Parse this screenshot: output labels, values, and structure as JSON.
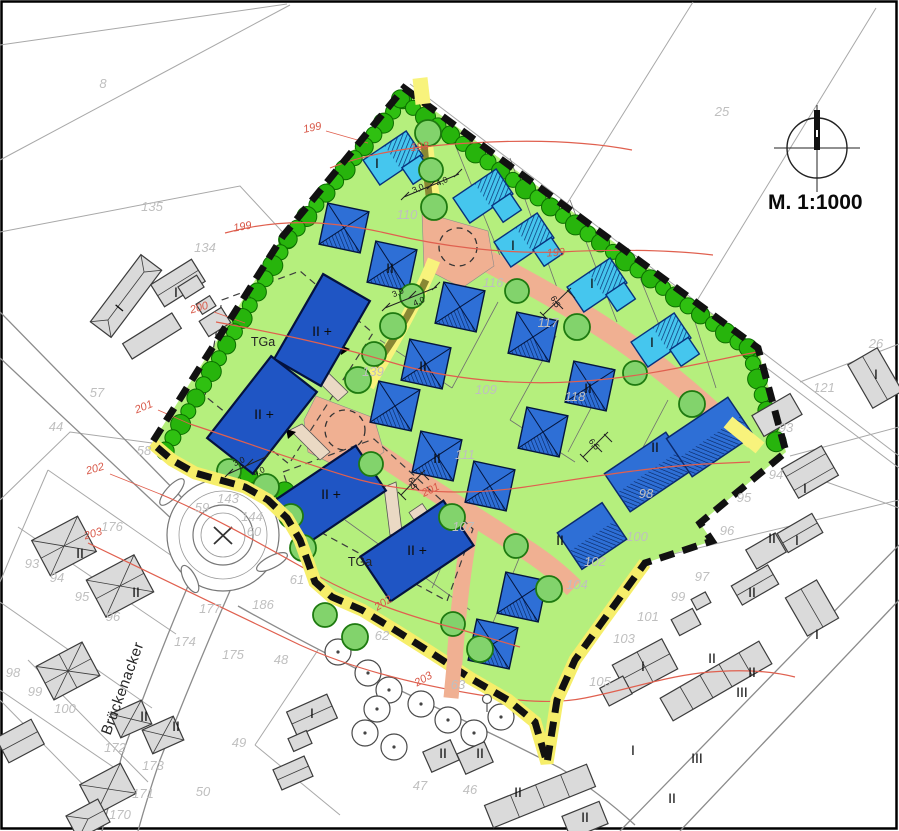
{
  "map": {
    "type": "development-site-plan",
    "scale_text": "M. 1:1000",
    "street_name": "Brückenacker",
    "colors": {
      "site_green": "#b5ef7d",
      "road_salmon": "#f0b092",
      "path_yellow": "#f8f37c",
      "hedge_green": "#2fc011",
      "street_tree_green": "#82d36c",
      "house_cyan": "#45c6ee",
      "house_blue": "#2e6fd6",
      "building_navy": "#1f55c4",
      "boundary_black": "#111111",
      "contour_red": "#e0604f",
      "existing_building_gray": "#dadada",
      "parcel_number_gray": "#bfbfbf"
    },
    "labels": [
      {
        "i": "parcel-8",
        "t": "8",
        "x": 103,
        "y": 88,
        "r": 0,
        "c": "p"
      },
      {
        "i": "parcel-135",
        "t": "135",
        "x": 152,
        "y": 211,
        "r": 0,
        "c": "p"
      },
      {
        "i": "parcel-134",
        "t": "134",
        "x": 205,
        "y": 252,
        "r": 0,
        "c": "p"
      },
      {
        "i": "parcel-25",
        "t": "25",
        "x": 722,
        "y": 116,
        "r": 0,
        "c": "p"
      },
      {
        "i": "parcel-26",
        "t": "26",
        "x": 876,
        "y": 348,
        "r": 0,
        "c": "p"
      },
      {
        "i": "parcel-121",
        "t": "121",
        "x": 824,
        "y": 392,
        "r": 0,
        "c": "p"
      },
      {
        "i": "parcel-93-e",
        "t": "93",
        "x": 786,
        "y": 432,
        "r": 0,
        "c": "p"
      },
      {
        "i": "parcel-94-e",
        "t": "94",
        "x": 776,
        "y": 479,
        "r": 0,
        "c": "p"
      },
      {
        "i": "parcel-95-e",
        "t": "95",
        "x": 744,
        "y": 502,
        "r": 0,
        "c": "p"
      },
      {
        "i": "parcel-96-e",
        "t": "96",
        "x": 727,
        "y": 535,
        "r": 0,
        "c": "p"
      },
      {
        "i": "parcel-97",
        "t": "97",
        "x": 702,
        "y": 581,
        "r": 0,
        "c": "p"
      },
      {
        "i": "parcel-99-e",
        "t": "99",
        "x": 678,
        "y": 601,
        "r": 0,
        "c": "p"
      },
      {
        "i": "parcel-101",
        "t": "101",
        "x": 648,
        "y": 621,
        "r": 0,
        "c": "p"
      },
      {
        "i": "parcel-103",
        "t": "103",
        "x": 624,
        "y": 643,
        "r": 0,
        "c": "p"
      },
      {
        "i": "parcel-105",
        "t": "105",
        "x": 600,
        "y": 686,
        "r": 0,
        "c": "p"
      },
      {
        "i": "parcel-57",
        "t": "57",
        "x": 97,
        "y": 397,
        "r": 0,
        "c": "p"
      },
      {
        "i": "parcel-44",
        "t": "44",
        "x": 56,
        "y": 431,
        "r": 0,
        "c": "p"
      },
      {
        "i": "parcel-58",
        "t": "58",
        "x": 144,
        "y": 455,
        "r": 0,
        "c": "p"
      },
      {
        "i": "parcel-59",
        "t": "59",
        "x": 202,
        "y": 512,
        "r": 0,
        "c": "p"
      },
      {
        "i": "parcel-143",
        "t": "143",
        "x": 228,
        "y": 503,
        "r": 0,
        "c": "p"
      },
      {
        "i": "parcel-144",
        "t": "144",
        "x": 252,
        "y": 521,
        "r": 0,
        "c": "p"
      },
      {
        "i": "parcel-60",
        "t": "60",
        "x": 254,
        "y": 536,
        "r": 0,
        "c": "p"
      },
      {
        "i": "parcel-61",
        "t": "61",
        "x": 297,
        "y": 584,
        "r": 0,
        "c": "p"
      },
      {
        "i": "parcel-62",
        "t": "62",
        "x": 382,
        "y": 640,
        "r": 0,
        "c": "p"
      },
      {
        "i": "parcel-63",
        "t": "63",
        "x": 458,
        "y": 689,
        "r": 0,
        "c": "p"
      },
      {
        "i": "parcel-176",
        "t": "176",
        "x": 112,
        "y": 531,
        "r": 0,
        "c": "p"
      },
      {
        "i": "parcel-177",
        "t": "177",
        "x": 210,
        "y": 613,
        "r": 0,
        "c": "p"
      },
      {
        "i": "parcel-186",
        "t": "186",
        "x": 263,
        "y": 609,
        "r": 0,
        "c": "p"
      },
      {
        "i": "parcel-174",
        "t": "174",
        "x": 185,
        "y": 646,
        "r": 0,
        "c": "p"
      },
      {
        "i": "parcel-175",
        "t": "175",
        "x": 233,
        "y": 659,
        "r": 0,
        "c": "p"
      },
      {
        "i": "parcel-93-w",
        "t": "93",
        "x": 32,
        "y": 568,
        "r": 0,
        "c": "p"
      },
      {
        "i": "parcel-94-w",
        "t": "94",
        "x": 57,
        "y": 582,
        "r": 0,
        "c": "p"
      },
      {
        "i": "parcel-95-w",
        "t": "95",
        "x": 82,
        "y": 601,
        "r": 0,
        "c": "p"
      },
      {
        "i": "parcel-96-w",
        "t": "96",
        "x": 113,
        "y": 621,
        "r": 0,
        "c": "p"
      },
      {
        "i": "parcel-98-w",
        "t": "98",
        "x": 13,
        "y": 677,
        "r": 0,
        "c": "p"
      },
      {
        "i": "parcel-99-w",
        "t": "99",
        "x": 35,
        "y": 696,
        "r": 0,
        "c": "p"
      },
      {
        "i": "parcel-100-w",
        "t": "100",
        "x": 65,
        "y": 713,
        "r": 0,
        "c": "p"
      },
      {
        "i": "parcel-172",
        "t": "172",
        "x": 115,
        "y": 752,
        "r": 0,
        "c": "p"
      },
      {
        "i": "parcel-173",
        "t": "173",
        "x": 153,
        "y": 770,
        "r": 0,
        "c": "p"
      },
      {
        "i": "parcel-171",
        "t": "171",
        "x": 143,
        "y": 798,
        "r": 0,
        "c": "p"
      },
      {
        "i": "parcel-170",
        "t": "170",
        "x": 120,
        "y": 819,
        "r": 0,
        "c": "p"
      },
      {
        "i": "parcel-49",
        "t": "49",
        "x": 239,
        "y": 747,
        "r": 0,
        "c": "p"
      },
      {
        "i": "parcel-50",
        "t": "50",
        "x": 203,
        "y": 796,
        "r": 0,
        "c": "p"
      },
      {
        "i": "parcel-47",
        "t": "47",
        "x": 420,
        "y": 790,
        "r": 0,
        "c": "p"
      },
      {
        "i": "parcel-46",
        "t": "46",
        "x": 470,
        "y": 794,
        "r": 0,
        "c": "p"
      },
      {
        "i": "parcel-48",
        "t": "48",
        "x": 281,
        "y": 664,
        "r": 0,
        "c": "p"
      },
      {
        "i": "parcel-110",
        "t": "110",
        "x": 407,
        "y": 219,
        "r": 0,
        "c": "p"
      },
      {
        "i": "parcel-116",
        "t": "116",
        "x": 493,
        "y": 287,
        "r": 0,
        "c": "p"
      },
      {
        "i": "parcel-117",
        "t": "117",
        "x": 548,
        "y": 327,
        "r": 0,
        "c": "p"
      },
      {
        "i": "parcel-139",
        "t": "139",
        "x": 373,
        "y": 376,
        "r": 0,
        "c": "p"
      },
      {
        "i": "parcel-109",
        "t": "109",
        "x": 486,
        "y": 394,
        "r": 0,
        "c": "p"
      },
      {
        "i": "parcel-118",
        "t": "118",
        "x": 575,
        "y": 401,
        "r": 0,
        "c": "p"
      },
      {
        "i": "parcel-111",
        "t": "111",
        "x": 465,
        "y": 459,
        "r": 0,
        "c": "p"
      },
      {
        "i": "parcel-107",
        "t": "107",
        "x": 463,
        "y": 531,
        "r": 0,
        "c": "p"
      },
      {
        "i": "parcel-98-s",
        "t": "98",
        "x": 646,
        "y": 498,
        "r": 0,
        "c": "p"
      },
      {
        "i": "parcel-100-s",
        "t": "100",
        "x": 637,
        "y": 541,
        "r": 0,
        "c": "p"
      },
      {
        "i": "parcel-102",
        "t": "102",
        "x": 595,
        "y": 566,
        "r": 0,
        "c": "p"
      },
      {
        "i": "parcel-104",
        "t": "104",
        "x": 577,
        "y": 589,
        "r": 0,
        "c": "p"
      },
      {
        "i": "contour-199-n",
        "t": "199",
        "x": 313,
        "y": 131,
        "r": -12,
        "c": "k"
      },
      {
        "i": "contour-198",
        "t": "198",
        "x": 420,
        "y": 150,
        "r": -6,
        "c": "k"
      },
      {
        "i": "contour-199-w",
        "t": "199",
        "x": 243,
        "y": 230,
        "r": -10,
        "c": "k"
      },
      {
        "i": "contour-199-e",
        "t": "199",
        "x": 556,
        "y": 256,
        "r": -4,
        "c": "k"
      },
      {
        "i": "contour-200",
        "t": "200",
        "x": 200,
        "y": 311,
        "r": -16,
        "c": "k"
      },
      {
        "i": "contour-201-w",
        "t": "201",
        "x": 145,
        "y": 410,
        "r": -22,
        "c": "k"
      },
      {
        "i": "contour-202-w",
        "t": "202",
        "x": 96,
        "y": 472,
        "r": -16,
        "c": "k"
      },
      {
        "i": "contour-203-w",
        "t": "203",
        "x": 94,
        "y": 537,
        "r": -16,
        "c": "k"
      },
      {
        "i": "contour-201-m",
        "t": "201",
        "x": 432,
        "y": 493,
        "r": -26,
        "c": "k"
      },
      {
        "i": "contour-202-m",
        "t": "202",
        "x": 385,
        "y": 606,
        "r": -32,
        "c": "k"
      },
      {
        "i": "contour-203-m",
        "t": "203",
        "x": 425,
        "y": 682,
        "r": -30,
        "c": "k"
      },
      {
        "i": "dim-30-a",
        "t": "3,0",
        "x": 419,
        "y": 191,
        "r": -24,
        "c": "d"
      },
      {
        "i": "dim-40-a",
        "t": "4,0",
        "x": 443,
        "y": 184,
        "r": -24,
        "c": "d"
      },
      {
        "i": "dim-30-b",
        "t": "3,0",
        "x": 399,
        "y": 295,
        "r": -24,
        "c": "d"
      },
      {
        "i": "dim-40-b",
        "t": "4,0",
        "x": 420,
        "y": 304,
        "r": -24,
        "c": "d"
      },
      {
        "i": "dim-30-c",
        "t": "3,0",
        "x": 240,
        "y": 464,
        "r": -24,
        "c": "d"
      },
      {
        "i": "dim-40-c",
        "t": "4,0",
        "x": 260,
        "y": 474,
        "r": -24,
        "c": "d"
      },
      {
        "i": "dim-65-a",
        "t": "6,5",
        "x": 553,
        "y": 303,
        "r": 62,
        "c": "d"
      },
      {
        "i": "dim-65-b",
        "t": "6,5",
        "x": 592,
        "y": 446,
        "r": 50,
        "c": "d"
      },
      {
        "i": "dim-65-c",
        "t": "6,5",
        "x": 410,
        "y": 484,
        "r": 72,
        "c": "d"
      },
      {
        "i": "house-c1",
        "t": "I",
        "x": 377,
        "y": 168,
        "r": 0,
        "c": "m"
      },
      {
        "i": "house-c3",
        "t": "I",
        "x": 513,
        "y": 250,
        "r": 0,
        "c": "m"
      },
      {
        "i": "house-c4",
        "t": "I",
        "x": 592,
        "y": 288,
        "r": 0,
        "c": "m"
      },
      {
        "i": "house-c5",
        "t": "I",
        "x": 652,
        "y": 347,
        "r": 0,
        "c": "m"
      },
      {
        "i": "house-p1",
        "t": "II",
        "x": 390,
        "y": 273,
        "r": 0,
        "c": "m"
      },
      {
        "i": "house-p4",
        "t": "II",
        "x": 423,
        "y": 371,
        "r": 0,
        "c": "m"
      },
      {
        "i": "house-p6",
        "t": "II",
        "x": 588,
        "y": 393,
        "r": 0,
        "c": "m"
      },
      {
        "i": "house-p8",
        "t": "II",
        "x": 437,
        "y": 463,
        "r": 0,
        "c": "m"
      },
      {
        "i": "house-r1",
        "t": "II",
        "x": 655,
        "y": 452,
        "r": 0,
        "c": "m"
      },
      {
        "i": "house-r3",
        "t": "II",
        "x": 560,
        "y": 545,
        "r": 0,
        "c": "m"
      },
      {
        "i": "mfh-b1",
        "t": "II +",
        "x": 322,
        "y": 336,
        "r": 0,
        "c": "m"
      },
      {
        "i": "mfh-b2",
        "t": "II +",
        "x": 264,
        "y": 419,
        "r": 0,
        "c": "m"
      },
      {
        "i": "mfh-b3",
        "t": "II +",
        "x": 331,
        "y": 499,
        "r": 0,
        "c": "m"
      },
      {
        "i": "mfh-b4",
        "t": "II +",
        "x": 417,
        "y": 555,
        "r": 0,
        "c": "m"
      },
      {
        "i": "tga-1",
        "t": "TGa",
        "x": 263,
        "y": 346,
        "r": 0,
        "c": "g"
      },
      {
        "i": "tga-2",
        "t": "TGa",
        "x": 360,
        "y": 566,
        "r": 0,
        "c": "g"
      },
      {
        "i": "ex-g2",
        "t": "I",
        "x": 176,
        "y": 297,
        "r": 0,
        "c": "m"
      },
      {
        "i": "ex-barn",
        "t": "I",
        "x": 123,
        "y": 311,
        "r": -50,
        "c": "m"
      },
      {
        "i": "ex-x1",
        "t": "II",
        "x": 80,
        "y": 558,
        "r": 0,
        "c": "m"
      },
      {
        "i": "ex-x2",
        "t": "II",
        "x": 136,
        "y": 597,
        "r": 0,
        "c": "m"
      },
      {
        "i": "ex-x5a",
        "t": "II",
        "x": 144,
        "y": 721,
        "r": 0,
        "c": "m"
      },
      {
        "i": "ex-x5b",
        "t": "II",
        "x": 176,
        "y": 731,
        "r": 0,
        "c": "m"
      },
      {
        "i": "ex-bl1",
        "t": "I",
        "x": 312,
        "y": 718,
        "r": 0,
        "c": "m"
      },
      {
        "i": "ex-t1a",
        "t": "II",
        "x": 443,
        "y": 758,
        "r": 0,
        "c": "m"
      },
      {
        "i": "ex-t1b",
        "t": "II",
        "x": 480,
        "y": 758,
        "r": 0,
        "c": "m"
      },
      {
        "i": "ex-t2",
        "t": "II",
        "x": 518,
        "y": 797,
        "r": 0,
        "c": "m"
      },
      {
        "i": "ex-t3",
        "t": "II",
        "x": 585,
        "y": 822,
        "r": 0,
        "c": "m"
      },
      {
        "i": "ex-e1",
        "t": "I",
        "x": 643,
        "y": 671,
        "r": 0,
        "c": "m"
      },
      {
        "i": "ex-e4",
        "t": "II",
        "x": 752,
        "y": 597,
        "r": 0,
        "c": "m"
      },
      {
        "i": "ex-e3a",
        "t": "II",
        "x": 712,
        "y": 663,
        "r": 0,
        "c": "m"
      },
      {
        "i": "ex-e3b",
        "t": "II",
        "x": 752,
        "y": 677,
        "r": 0,
        "c": "m"
      },
      {
        "i": "ex-e3c",
        "t": "III",
        "x": 742,
        "y": 697,
        "r": 0,
        "c": "m"
      },
      {
        "i": "ex-s105",
        "t": "I",
        "x": 633,
        "y": 755,
        "r": 0,
        "c": "m"
      },
      {
        "i": "ex-t4",
        "t": "III",
        "x": 697,
        "y": 763,
        "r": 0,
        "c": "m"
      },
      {
        "i": "ex-t5",
        "t": "II",
        "x": 672,
        "y": 803,
        "r": 0,
        "c": "m"
      },
      {
        "i": "ex-e5",
        "t": "I",
        "x": 817,
        "y": 639,
        "r": 0,
        "c": "m"
      },
      {
        "i": "ex-e7",
        "t": "I",
        "x": 805,
        "y": 493,
        "r": 0,
        "c": "m"
      },
      {
        "i": "ex-e8",
        "t": "I",
        "x": 797,
        "y": 545,
        "r": 0,
        "c": "m"
      },
      {
        "i": "ex-e9",
        "t": "II",
        "x": 772,
        "y": 543,
        "r": 0,
        "c": "m"
      },
      {
        "i": "ex-e10",
        "t": "I",
        "x": 876,
        "y": 379,
        "r": 0,
        "c": "m"
      },
      {
        "i": "street-brueckenacker",
        "t": "Brückenacker",
        "x": 127,
        "y": 690,
        "r": -70,
        "c": "s"
      },
      {
        "i": "scale-text",
        "t": "M. 1:1000",
        "x": 768,
        "y": 209,
        "r": 0,
        "c": "z"
      }
    ]
  }
}
